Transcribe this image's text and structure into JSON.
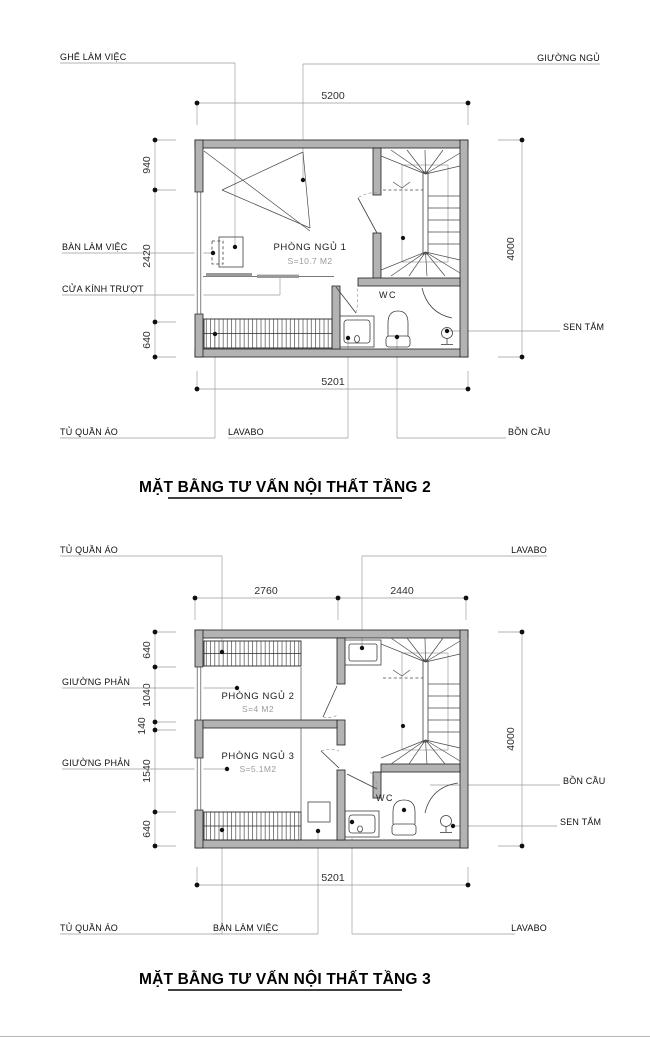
{
  "document": {
    "type": "interior-consulting-floor-plans",
    "colors": {
      "wall_fill": "#b3b3b3",
      "wall_stroke": "#1f1f1f",
      "leader_line": "#9a9a9a",
      "label_text": "#101010",
      "area_text": "#9b9b9b",
      "background": "#ffffff"
    }
  },
  "plan2": {
    "title": "MẶT BẰNG TƯ VẤN NỘI THẤT TẦNG 2",
    "rooms": {
      "bedroom1_name": "PHÒNG NGỦ 1",
      "bedroom1_area": "S=10.7 M2",
      "wc": "WC"
    },
    "labels": {
      "chair": "GHẾ LÀM VIỆC",
      "bed": "GIƯỜNG NGỦ",
      "desk": "BÀN LÀM VIỆC",
      "sliding_door": "CỬA KÍNH TRƯỢT",
      "shower": "SEN TẮM",
      "wardrobe": "TỦ QUẦN ÁO",
      "sink": "LAVABO",
      "toilet": "BỒN CẦU"
    },
    "dims": {
      "top": "5200",
      "bottom": "5201",
      "right": "4000",
      "left_top": "940",
      "left_mid": "2420",
      "left_bottom": "640"
    }
  },
  "plan3": {
    "title": "MẶT BẰNG TƯ VẤN NỘI THẤT TẦNG 3",
    "rooms": {
      "bedroom2_name": "PHÒNG NGỦ 2",
      "bedroom2_area": "S=4 M2",
      "bedroom3_name": "PHÒNG NGỦ 3",
      "bedroom3_area": "S=5.1M2",
      "wc": "WC"
    },
    "labels": {
      "wardrobe_top": "TỦ QUẦN ÁO",
      "sink_top": "LAVABO",
      "bed_upper": "GIƯỜNG PHẢN",
      "bed_lower": "GIƯỜNG PHẢN",
      "toilet": "BỒN CẦU",
      "shower": "SEN TẮM",
      "wardrobe_bottom": "TỦ QUẦN ÁO",
      "desk": "BÀN LÀM VIỆC",
      "sink_bottom": "LAVABO"
    },
    "dims": {
      "top_left": "2760",
      "top_right": "2440",
      "bottom": "5201",
      "right": "4000",
      "left_1": "640",
      "left_2": "1040",
      "left_3": "140",
      "left_4": "1540",
      "left_5": "640"
    }
  }
}
